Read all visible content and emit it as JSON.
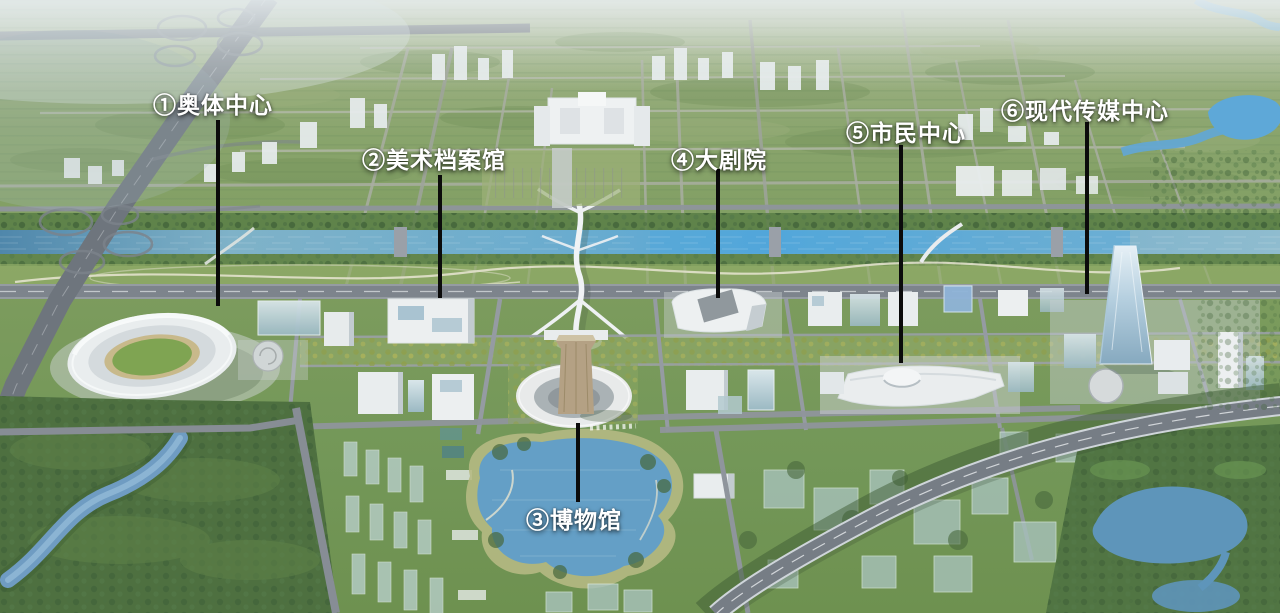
{
  "landmarks": [
    {
      "id": "olympic-sports-center",
      "number": "①",
      "name": "奥体中心",
      "label": "①奥体中心"
    },
    {
      "id": "art-archives",
      "number": "②",
      "name": "美术档案馆",
      "label": "②美术档案馆"
    },
    {
      "id": "museum",
      "number": "③",
      "name": "博物馆",
      "label": "③博物馆"
    },
    {
      "id": "grand-theater",
      "number": "④",
      "name": "大剧院",
      "label": "④大剧院"
    },
    {
      "id": "civic-center",
      "number": "⑤",
      "name": "市民中心",
      "label": "⑤市民中心"
    },
    {
      "id": "modern-media-center",
      "number": "⑥",
      "name": "现代传媒中心",
      "label": "⑥现代传媒中心"
    }
  ],
  "annotation_style": {
    "label_color": "#ffffff",
    "callout_line_color": "#0b0b0b"
  },
  "palette": {
    "field_green": "#7d9a5f",
    "forest_green": "#4e7040",
    "river_blue": "#6aaccf",
    "lake_blue": "#649fc6",
    "road_gray": "#7d848c",
    "building_white": "#e9edee",
    "glass_blue": "#a9c3bd",
    "museum_tan": "#b4a184"
  }
}
